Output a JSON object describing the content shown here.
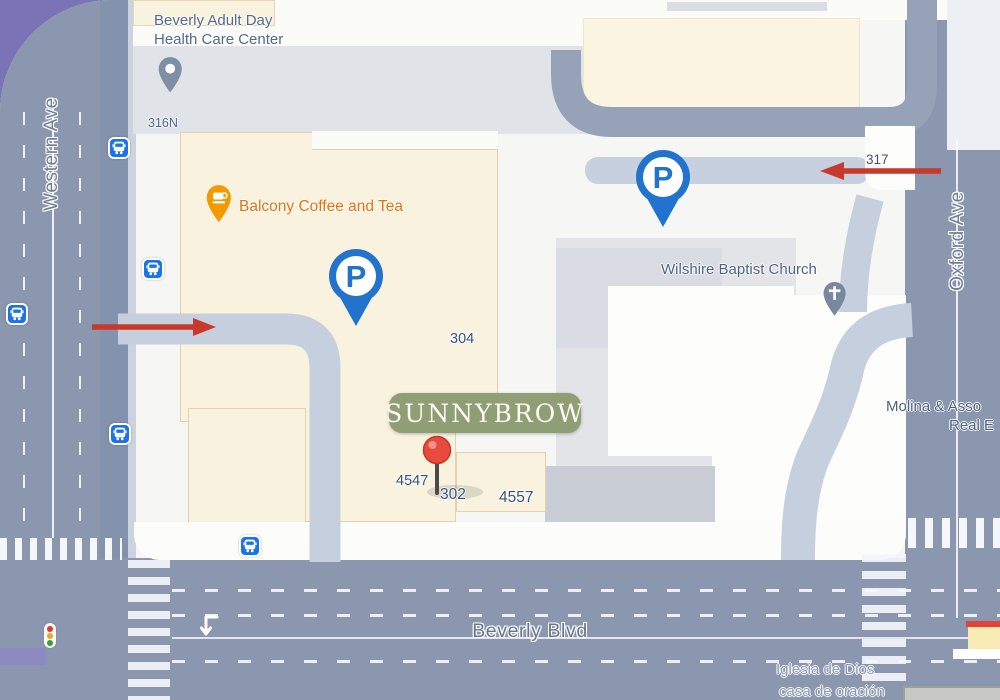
{
  "map": {
    "streets": {
      "western": "Western Ave",
      "oxford": "Oxford Ave",
      "beverly": "Beverly Blvd"
    },
    "numbers": {
      "n316n": "316N",
      "n317": "317",
      "n304": "304",
      "n302": "302",
      "n4557": "4557",
      "n4547": "4547"
    },
    "pois": {
      "beverly_adult": {
        "line1": "Beverly Adult Day",
        "line2": "Health Care Center"
      },
      "balcony": {
        "label": "Balcony Coffee and Tea"
      },
      "wilshire": {
        "label": "Wilshire Baptist Church"
      },
      "molina": {
        "line1": "Molina & Asso",
        "line2": "Real E"
      },
      "iglesia": {
        "line1": "Iglesia de Dios",
        "line2": "casa de oración"
      }
    },
    "marker": {
      "label": "SUNNYBROW"
    },
    "parking": {
      "label": "P"
    },
    "colors": {
      "background_purple": "#7a73b6",
      "road": "#8a97ae",
      "driveway": "#c5cfdd",
      "building_cream": "#f8f2df",
      "poi_orange": "#e8710a",
      "google_blue": "#1a73e8",
      "marker_green": "#8f9e75",
      "arrow_red": "#c6392b",
      "pin_red": "#e8453c"
    }
  }
}
